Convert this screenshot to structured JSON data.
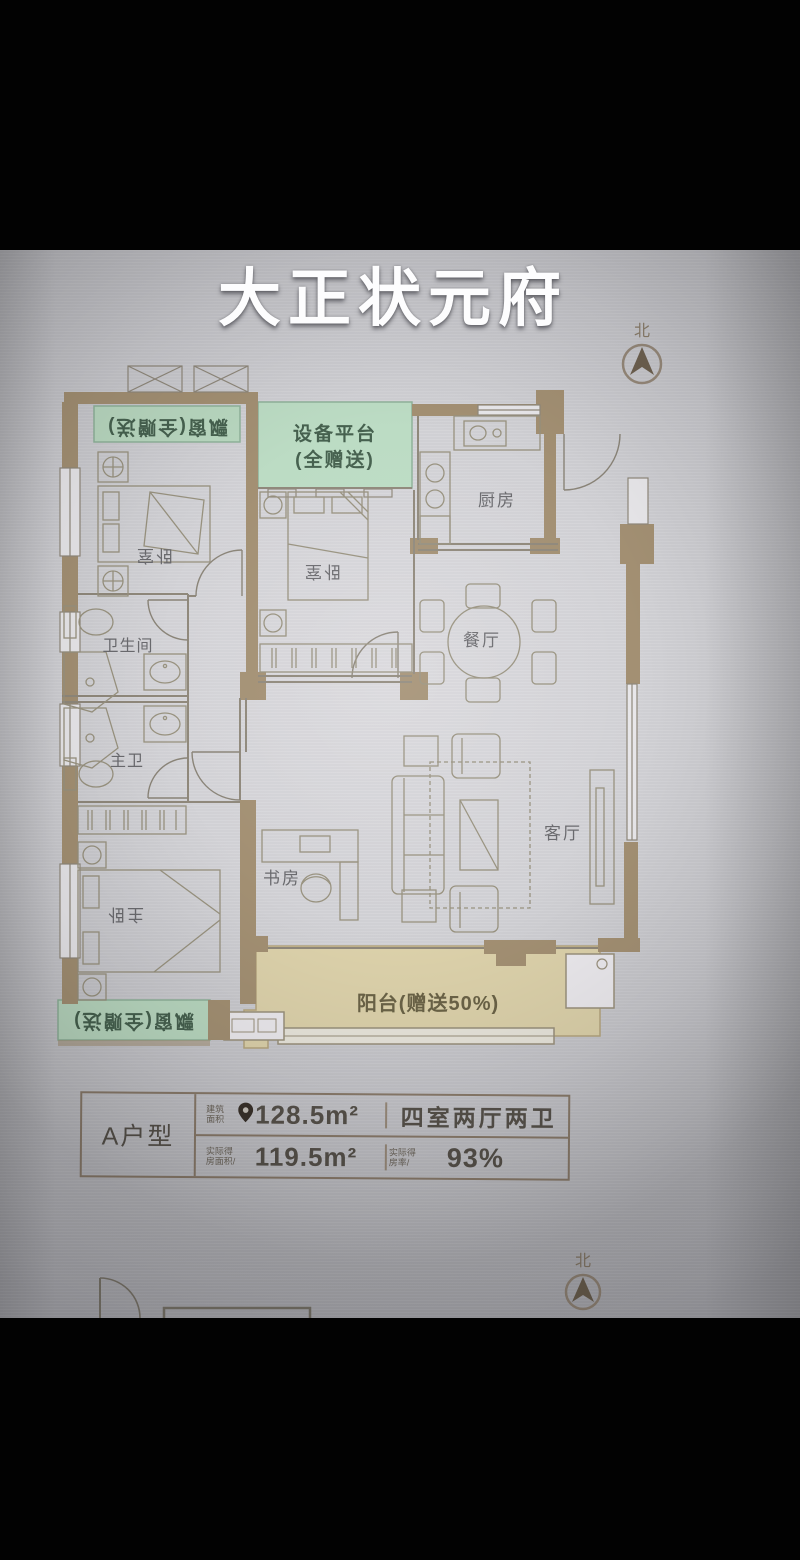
{
  "title": "大正状元府",
  "compass": {
    "north": "北"
  },
  "rooms": {
    "bedroom_top_left": "卧室",
    "bedroom_middle": "卧室",
    "kitchen": "厨房",
    "dining_room": "餐厅",
    "bathroom": "卫生间",
    "master_bathroom": "主卫",
    "master_bedroom": "主卧",
    "study": "书房",
    "living_room": "客厅"
  },
  "gift_zones": {
    "bay_window_top": "飘窗(全赠送)",
    "equipment_platform_line1": "设备平台",
    "equipment_platform_line2": "(全赠送)",
    "bay_window_bottom": "飘窗(全赠送)",
    "balcony": "阳台(赠送50%)"
  },
  "info_table": {
    "unit_type": "A户型",
    "built_area_label_line1": "建筑",
    "built_area_label_line2": "面积",
    "built_area_value": "128.5m²",
    "layout": "四室两厅两卫",
    "usable_area_label_line1": "实际得",
    "usable_area_label_line2": "房面积/",
    "usable_area_value": "119.5m²",
    "rate_label_line1": "实际得",
    "rate_label_line2": "房率/",
    "rate_value": "93%"
  },
  "colors": {
    "gift_green": "#b9d8c0",
    "gift_green_border": "#8fb29a",
    "balcony_tan": "#ddd2ab",
    "wall_tan": "#a39073",
    "line_gray": "#8f887b",
    "furniture_gray": "#98927f",
    "text_dark": "#57524b"
  }
}
